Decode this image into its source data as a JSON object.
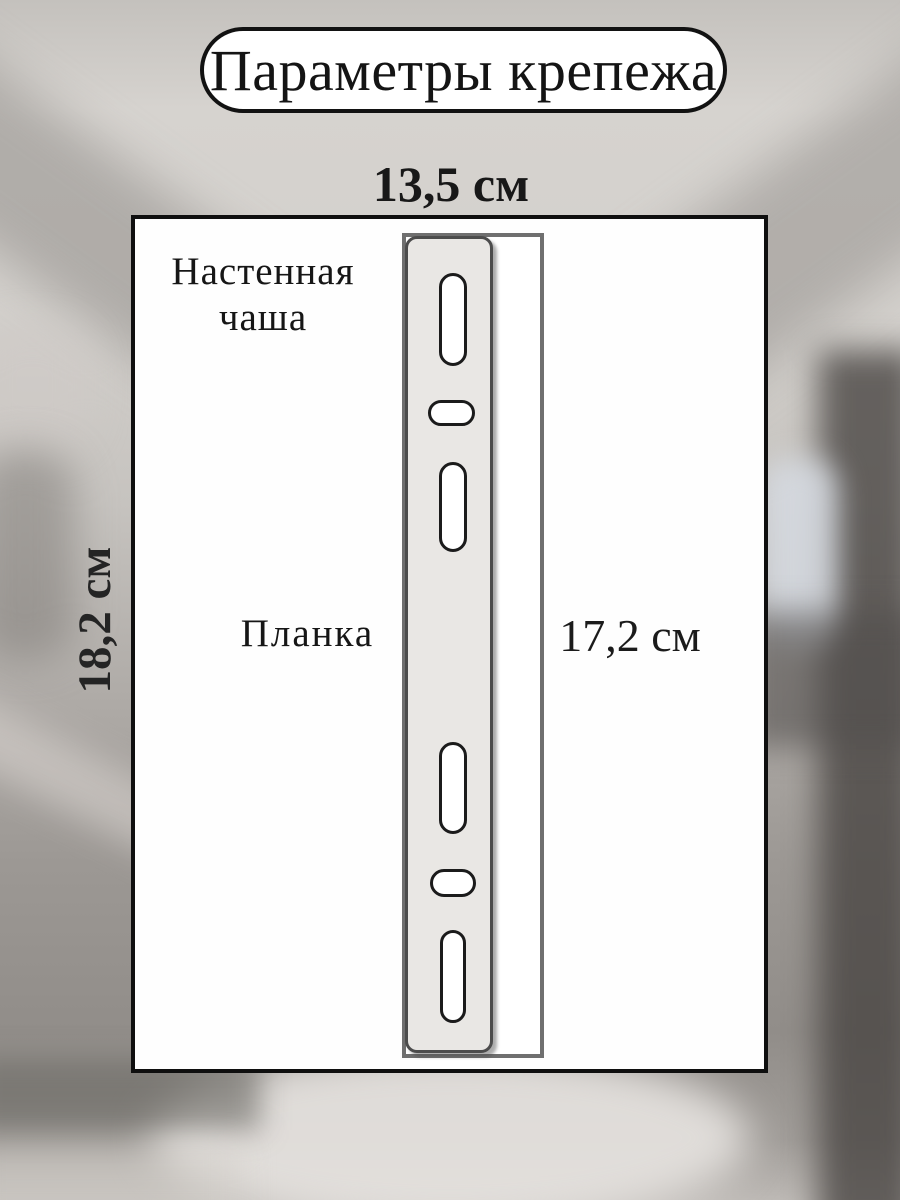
{
  "title": "Параметры крепежа",
  "dimensions": {
    "width_top": "13,5 см",
    "height_left": "18,2 см",
    "plate_height": "17,2 см"
  },
  "labels": {
    "wall_cup": "Настенная чаша",
    "plank": "Планка"
  },
  "colors": {
    "ink": "#1a1a1a",
    "box_border": "#0f0f0f",
    "pill_fill": "#ffffff",
    "plate_fill": "#e9e7e4",
    "plate_border": "#4c4c4c",
    "wallcup_outline": "#6f6f6f",
    "slot_border": "#1b1b1b",
    "background_light": "#d6d3cf",
    "background_dark": "#6e6a66"
  },
  "diagram": {
    "plate_slots": [
      {
        "type": "vertical",
        "left": 31,
        "top": 34,
        "width": 28,
        "height": 93
      },
      {
        "type": "horizontal",
        "left": 20,
        "top": 161,
        "width": 47,
        "height": 26
      },
      {
        "type": "vertical",
        "left": 31,
        "top": 223,
        "width": 28,
        "height": 90
      },
      {
        "type": "vertical",
        "left": 31,
        "top": 503,
        "width": 28,
        "height": 92
      },
      {
        "type": "horizontal",
        "left": 22,
        "top": 630,
        "width": 46,
        "height": 28
      },
      {
        "type": "vertical",
        "left": 32,
        "top": 691,
        "width": 26,
        "height": 93
      }
    ]
  }
}
